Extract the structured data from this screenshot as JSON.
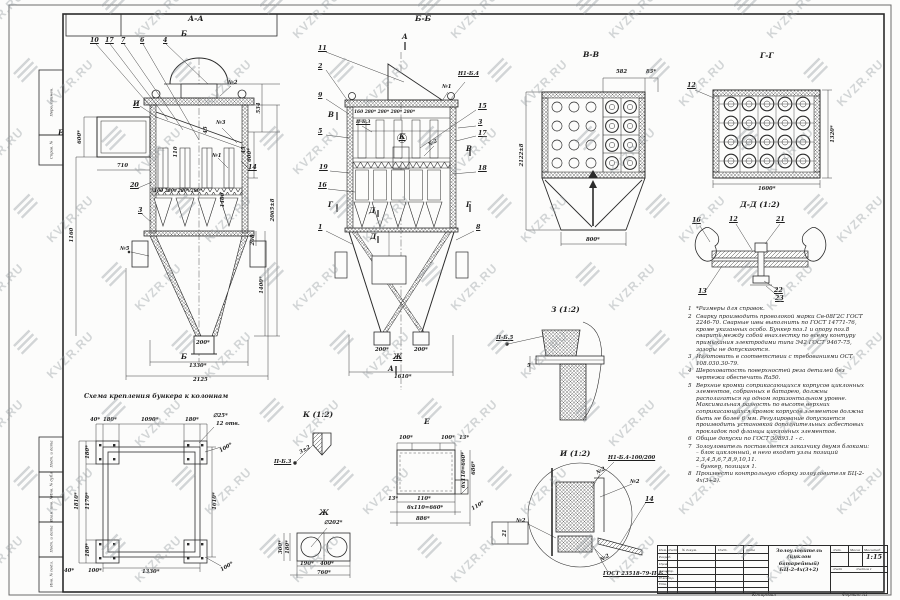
{
  "watermark": {
    "text": "KVZR.RU"
  },
  "frame": {
    "left_stamps": [
      "Перв. примен.",
      "Справ. №",
      "Подп. и дата",
      "Инв. № дубл.",
      "Взам. инв. №",
      "Подп. и дата",
      "Инв. № подл."
    ]
  },
  "views": {
    "aa": {
      "title": "А-А",
      "cut_top": "Б",
      "cut_bottom": "Б",
      "parts": {
        "p10": "10",
        "p17": "17",
        "p7": "7",
        "p6": "6",
        "p4": "4",
        "p20": "20",
        "p3": "3",
        "p14": "14",
        "i": "И",
        "e": "Е",
        "w2": "№2",
        "w3": "№3",
        "w1": "№1",
        "w5": "№5"
      },
      "dims": {
        "d534": "534",
        "d600l": "600*",
        "d600r": "600*",
        "d45a": "45",
        "d45b": "45",
        "d110": "110",
        "d710": "710",
        "d1160": "1160",
        "d2065": "2065±8",
        "d1400": "1400",
        "d208": "208",
        "d1400s": "1400*",
        "d200": "200*",
        "d1330": "1330*",
        "d2125": "2125",
        "row": "160  280*  280*  280*"
      }
    },
    "bb": {
      "title": "Б-Б",
      "cut_top": "А",
      "cut_bottom": "А",
      "parts": {
        "p11": "11",
        "p2": "2",
        "p9": "9",
        "p5": "5",
        "p19": "19",
        "p16": "16",
        "p1": "1",
        "p15": "15",
        "p3": "3",
        "p17": "17",
        "p18": "18",
        "p8": "8",
        "w1": "№1",
        "w2": "№2",
        "weld": "Н1-Б.4",
        "pb3": "П-Б.3",
        "k": "К",
        "d1": "Д",
        "d2": "Д",
        "v1": "В",
        "v2": "В",
        "g1": "Г",
        "g2": "Г",
        "zh": "Ж"
      },
      "dims": {
        "row": "160  280*  280*  280*  280*",
        "d200a": "200*",
        "d200b": "200*",
        "d1610": "1610*"
      }
    },
    "vv": {
      "title": "В-В",
      "dims": {
        "d582": "582",
        "d85": "85*",
        "d2122": "2122±8",
        "d800": "800*"
      }
    },
    "gg": {
      "title": "Г-Г",
      "part12": "12",
      "dims": {
        "d1600": "1600*",
        "d1320": "1320*"
      }
    },
    "dd": {
      "title": "Д-Д (1:2)",
      "parts": {
        "p16": "16",
        "p12": "12",
        "p21": "21",
        "p13": "13",
        "p22": "22",
        "p23": "23"
      }
    },
    "z": {
      "title": "З (1:2)",
      "weld": "П-Б.5",
      "dim5": "5"
    },
    "i": {
      "title": "И (1:2)",
      "weld1": "Н1-Б.4-100/200",
      "w2a": "№2",
      "w2b": "№2",
      "w2c": "№2",
      "w2d": "№2",
      "p14": "14",
      "d21": "21",
      "gost": "ГОСТ 23518-79-П-Б.3"
    },
    "k": {
      "title": "К (1:2)",
      "weld": "П-Б.3",
      "dim": "3±2"
    },
    "e": {
      "title": "Е",
      "dims": {
        "t100a": "100*",
        "t100b": "100*",
        "t13": "13*",
        "r660": "6х110=660*",
        "r686": "686*",
        "b13": "13*",
        "b110": "110*",
        "b660": "6х110=660*",
        "b886": "886*",
        "d110": "110*"
      }
    },
    "zh": {
      "title": "Ж",
      "dia": "∅202*",
      "dims": {
        "d300": "300*",
        "d180": "180*",
        "d190": "190*",
        "d400": "400*",
        "d760": "760*"
      }
    },
    "scheme": {
      "title": "Схема крепления бункера к колоннам",
      "dims": {
        "t40": "40*",
        "t180a": "180*",
        "t1090": "1090*",
        "t180b": "180*",
        "holes1": "∅25*",
        "holes2": "12 отв.",
        "l180a": "180*",
        "l1170": "1170*",
        "l1810": "1810*",
        "l180b": "180*",
        "b40": "40*",
        "b100": "100*",
        "b1330": "1330*",
        "r1610": "1610*",
        "r100a": "100*",
        "r100b": "100*"
      }
    }
  },
  "notes": {
    "items": [
      {
        "n": "1",
        "t": "*Размеры для справок."
      },
      {
        "n": "2",
        "t": "Сварку производить проволокой марки Св-08Г2С ГОСТ 2246-70. Сварные швы выполнить по ГОСТ 14771-76, кроме указанных особо. Бункер поз.1 и опору поз.8 сварить между собой внахлестку по всему контуру примыкания электродами типа Э42 ГОСТ 9467-75, зазоры не допускаются."
      },
      {
        "n": "3",
        "t": "Изготовить в соответствии с требованиями ОСТ 108.030.30-79."
      },
      {
        "n": "4",
        "t": "Шероховатость поверхностей реза деталей без чертежа обеспечить Ra50."
      },
      {
        "n": "5",
        "t": "Верхние кромки соприкасающихся корпусов циклонных элементов, собранных в батарею, должны располагаться на одном горизонтальном уровне. Максимальная разность по высоте верхних соприкасающихся кромок корпусов элементов должна быть не более 6 мм. Регулирование допускается производить установкой дополнительных асбестовых прокладок под фланцы циклонных элементов."
      },
      {
        "n": "6",
        "t": "Общие допуски по ГОСТ 30893.1 - с."
      },
      {
        "n": "7",
        "t": "Золоуловитель поставляется заказчику двумя блоками:\n– блок циклонный, в него входят узлы позиций 2,3,4,5,6,7,8,9,10,11.\n– бункер, позиция 1."
      },
      {
        "n": "8",
        "t": "Произвести контрольную сборку золоуловителя БЦ-2-4х(3+2)."
      }
    ]
  },
  "titleblock": {
    "product": "Золоуловитель\n(циклон батарейный)\nБЦ-2-4х(3+2)",
    "cols": [
      "Изм.",
      "Лист",
      "№ докум.",
      "Подп.",
      "Дата"
    ],
    "rows": [
      "Разраб.",
      "Пров.",
      "Т.контр.",
      "Н.контр.",
      "Утв."
    ],
    "lit_label": "Лит.",
    "mass_label": "Масса",
    "scale_label": "Масштаб",
    "scale": "1:15",
    "sheet_label": "Лист",
    "sheets_label": "Листов 1",
    "copied": "Копировал",
    "format": "Формат А1"
  }
}
